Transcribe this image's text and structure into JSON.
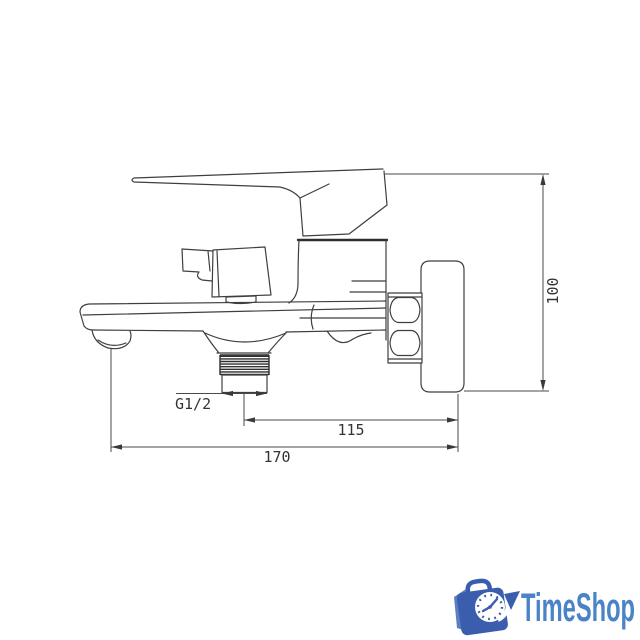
{
  "drawing": {
    "line_color": "#3f3f3f",
    "dimensions": {
      "height": "100",
      "outlet_to_wall": "115",
      "overall_depth": "170",
      "thread": "G1/2"
    }
  },
  "logo": {
    "text": "TimeShop",
    "text_color": "#4a83c6",
    "bag_color": "#3a5dad",
    "flap_color": "#5d7fbf",
    "clock_face_color": "#ffffff"
  }
}
